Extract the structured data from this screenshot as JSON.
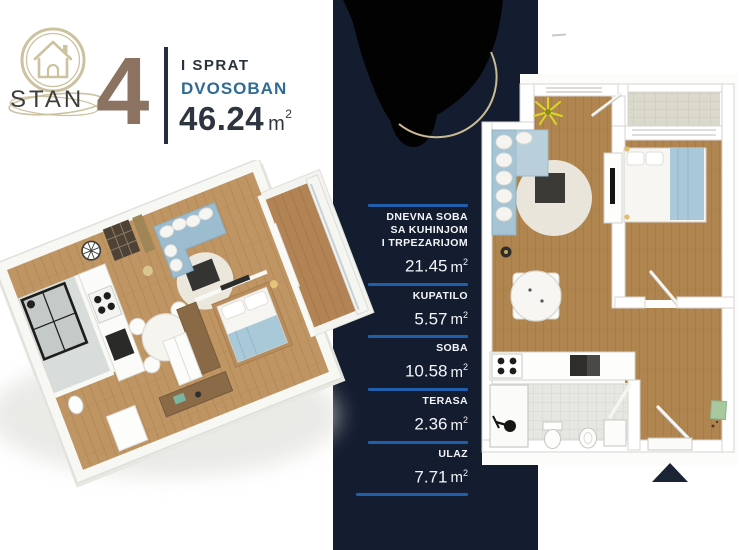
{
  "header": {
    "brand": "STAN",
    "unit_number": "4",
    "floor": "I SPRAT",
    "apartment_type": "DVOSOBAN",
    "total_area": "46.24",
    "area_unit": "m",
    "area_sup": "2"
  },
  "room_list": {
    "unit": "m",
    "sup": "2",
    "rooms": [
      {
        "name_lines": [
          "DNEVNA SOBA",
          "SA KUHINJOM",
          "I TRPEZARIJOM"
        ],
        "area": "21.45"
      },
      {
        "name_lines": [
          "KUPATILO"
        ],
        "area": "5.57"
      },
      {
        "name_lines": [
          "SOBA"
        ],
        "area": "10.58"
      },
      {
        "name_lines": [
          "TERASA"
        ],
        "area": "2.36"
      },
      {
        "name_lines": [
          "ULAZ"
        ],
        "area": "7.71"
      }
    ]
  },
  "icons": {
    "logo": "house-in-double-ring",
    "north_arrow": "up-triangle",
    "censored_area": "black-blob"
  },
  "colors": {
    "band_navy": "#141d30",
    "rule_blue": "#1f5fad",
    "unit_number_brown": "#8c7361",
    "type_blue": "#2f6b94",
    "logo_tan": "#cdc2a0",
    "wood_floor": "#b1854f",
    "sofa_blue": "#a6c4d4",
    "blanket_blue": "#a9c8d8"
  }
}
